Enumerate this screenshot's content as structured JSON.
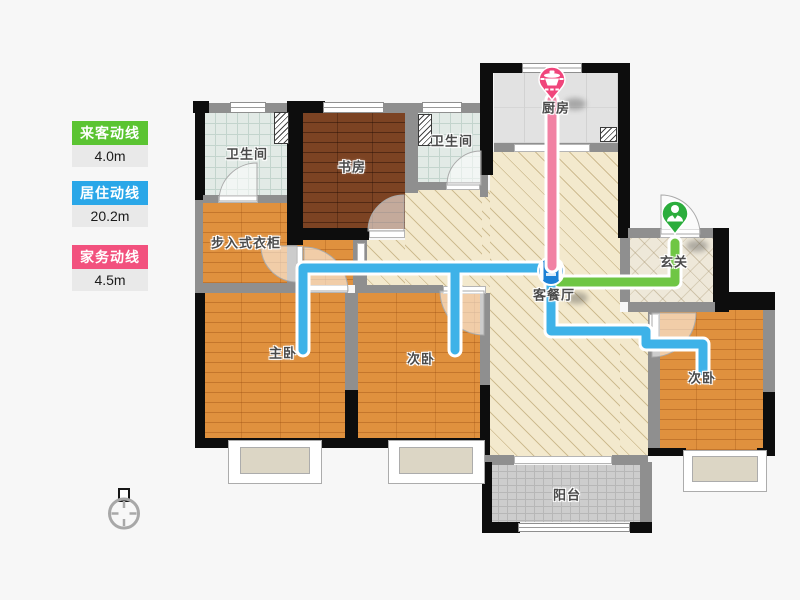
{
  "legend": {
    "items": [
      {
        "label": "来客动线",
        "value": "4.0m",
        "color": "#5BC432"
      },
      {
        "label": "居住动线",
        "value": "20.2m",
        "color": "#2AA7E8"
      },
      {
        "label": "家务动线",
        "value": "4.5m",
        "color": "#F2517E"
      }
    ]
  },
  "floorplan": {
    "rooms": [
      {
        "name": "卫生间"
      },
      {
        "name": "书房"
      },
      {
        "name": "卫生间"
      },
      {
        "name": "厨房"
      },
      {
        "name": "步入式衣柜"
      },
      {
        "name": "玄关"
      },
      {
        "name": "客餐厅"
      },
      {
        "name": "主卧"
      },
      {
        "name": "次卧"
      },
      {
        "name": "次卧"
      },
      {
        "name": "阳台"
      }
    ],
    "markers": [
      {
        "name": "kitchen-pin",
        "icon": "pot-icon",
        "color": "#F0457B",
        "room": "厨房"
      },
      {
        "name": "entry-pin",
        "icon": "person-icon",
        "color": "#2BAD3C",
        "room": "玄关"
      },
      {
        "name": "junction-marker",
        "icon": "sofa-icon",
        "color": "#1C80D5",
        "room": "客餐厅"
      }
    ],
    "routes": [
      {
        "name": "来客动线",
        "color": "#6FC644",
        "length": "4.0m"
      },
      {
        "name": "居住动线",
        "color": "#3EB2E8",
        "length": "20.2m"
      },
      {
        "name": "家务动线",
        "color": "#F0769B",
        "length": "4.5m"
      }
    ]
  }
}
